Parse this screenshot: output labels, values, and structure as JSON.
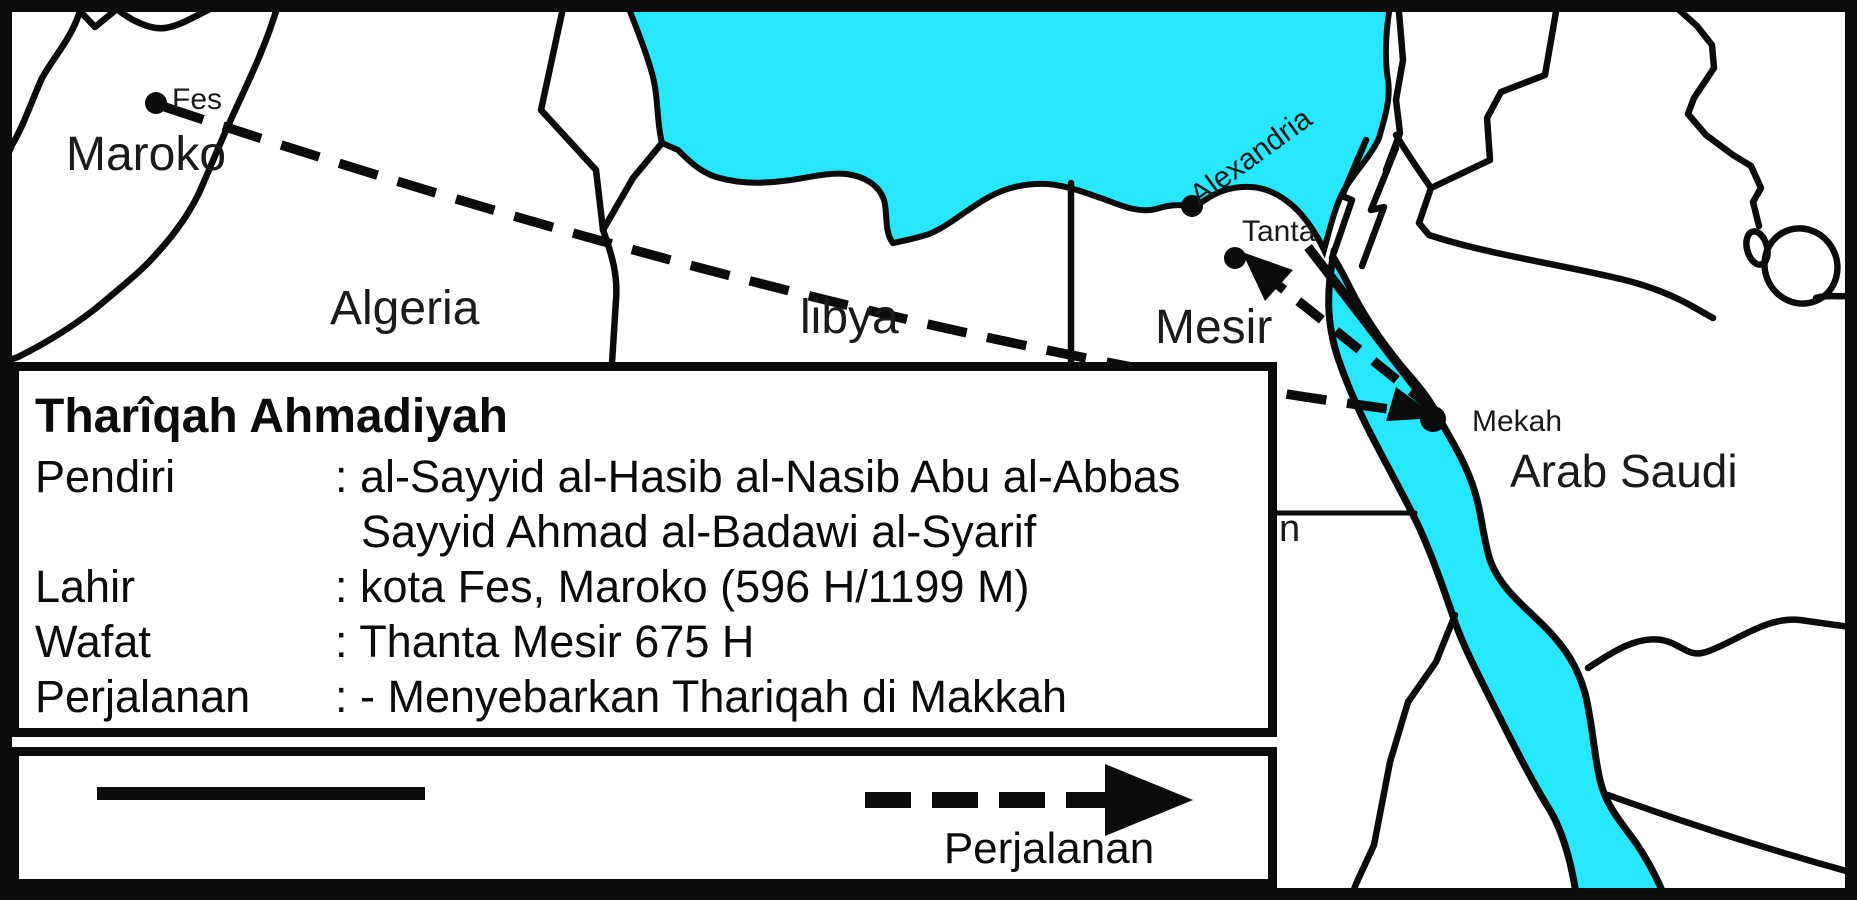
{
  "map": {
    "sea_color": "#26E7FC",
    "line_color": "#0b0b0b",
    "country_labels": {
      "maroko": "Maroko",
      "algeria": "Algeria",
      "libya": "libya",
      "mesir": "Mesir",
      "arab_saudi": "Arab Saudi",
      "sudan_fragment": "n"
    },
    "city_labels": {
      "fes": "Fes",
      "alexandria": "Alexandria",
      "tanta": "Tanta",
      "mekah": "Mekah"
    }
  },
  "info_box": {
    "title": "Tharîqah Ahmadiyah",
    "rows": [
      {
        "label": "Pendiri",
        "value": ": al-Sayyid al-Hasib al-Nasib Abu al-Abbas"
      },
      {
        "label": "",
        "value": "Sayyid Ahmad al-Badawi al-Syarif"
      },
      {
        "label": "Lahir",
        "value": ": kota Fes, Maroko (596 H/1199 M)"
      },
      {
        "label": "Wafat",
        "value": ": Thanta Mesir 675 H"
      },
      {
        "label": "Perjalanan",
        "value": ": - Menyebarkan Thariqah di Makkah"
      }
    ]
  },
  "legend": {
    "solid_line_icon": "solid-line-symbol",
    "journey_arrow_icon": "dashed-arrow-symbol",
    "journey_label": "Perjalanan"
  }
}
